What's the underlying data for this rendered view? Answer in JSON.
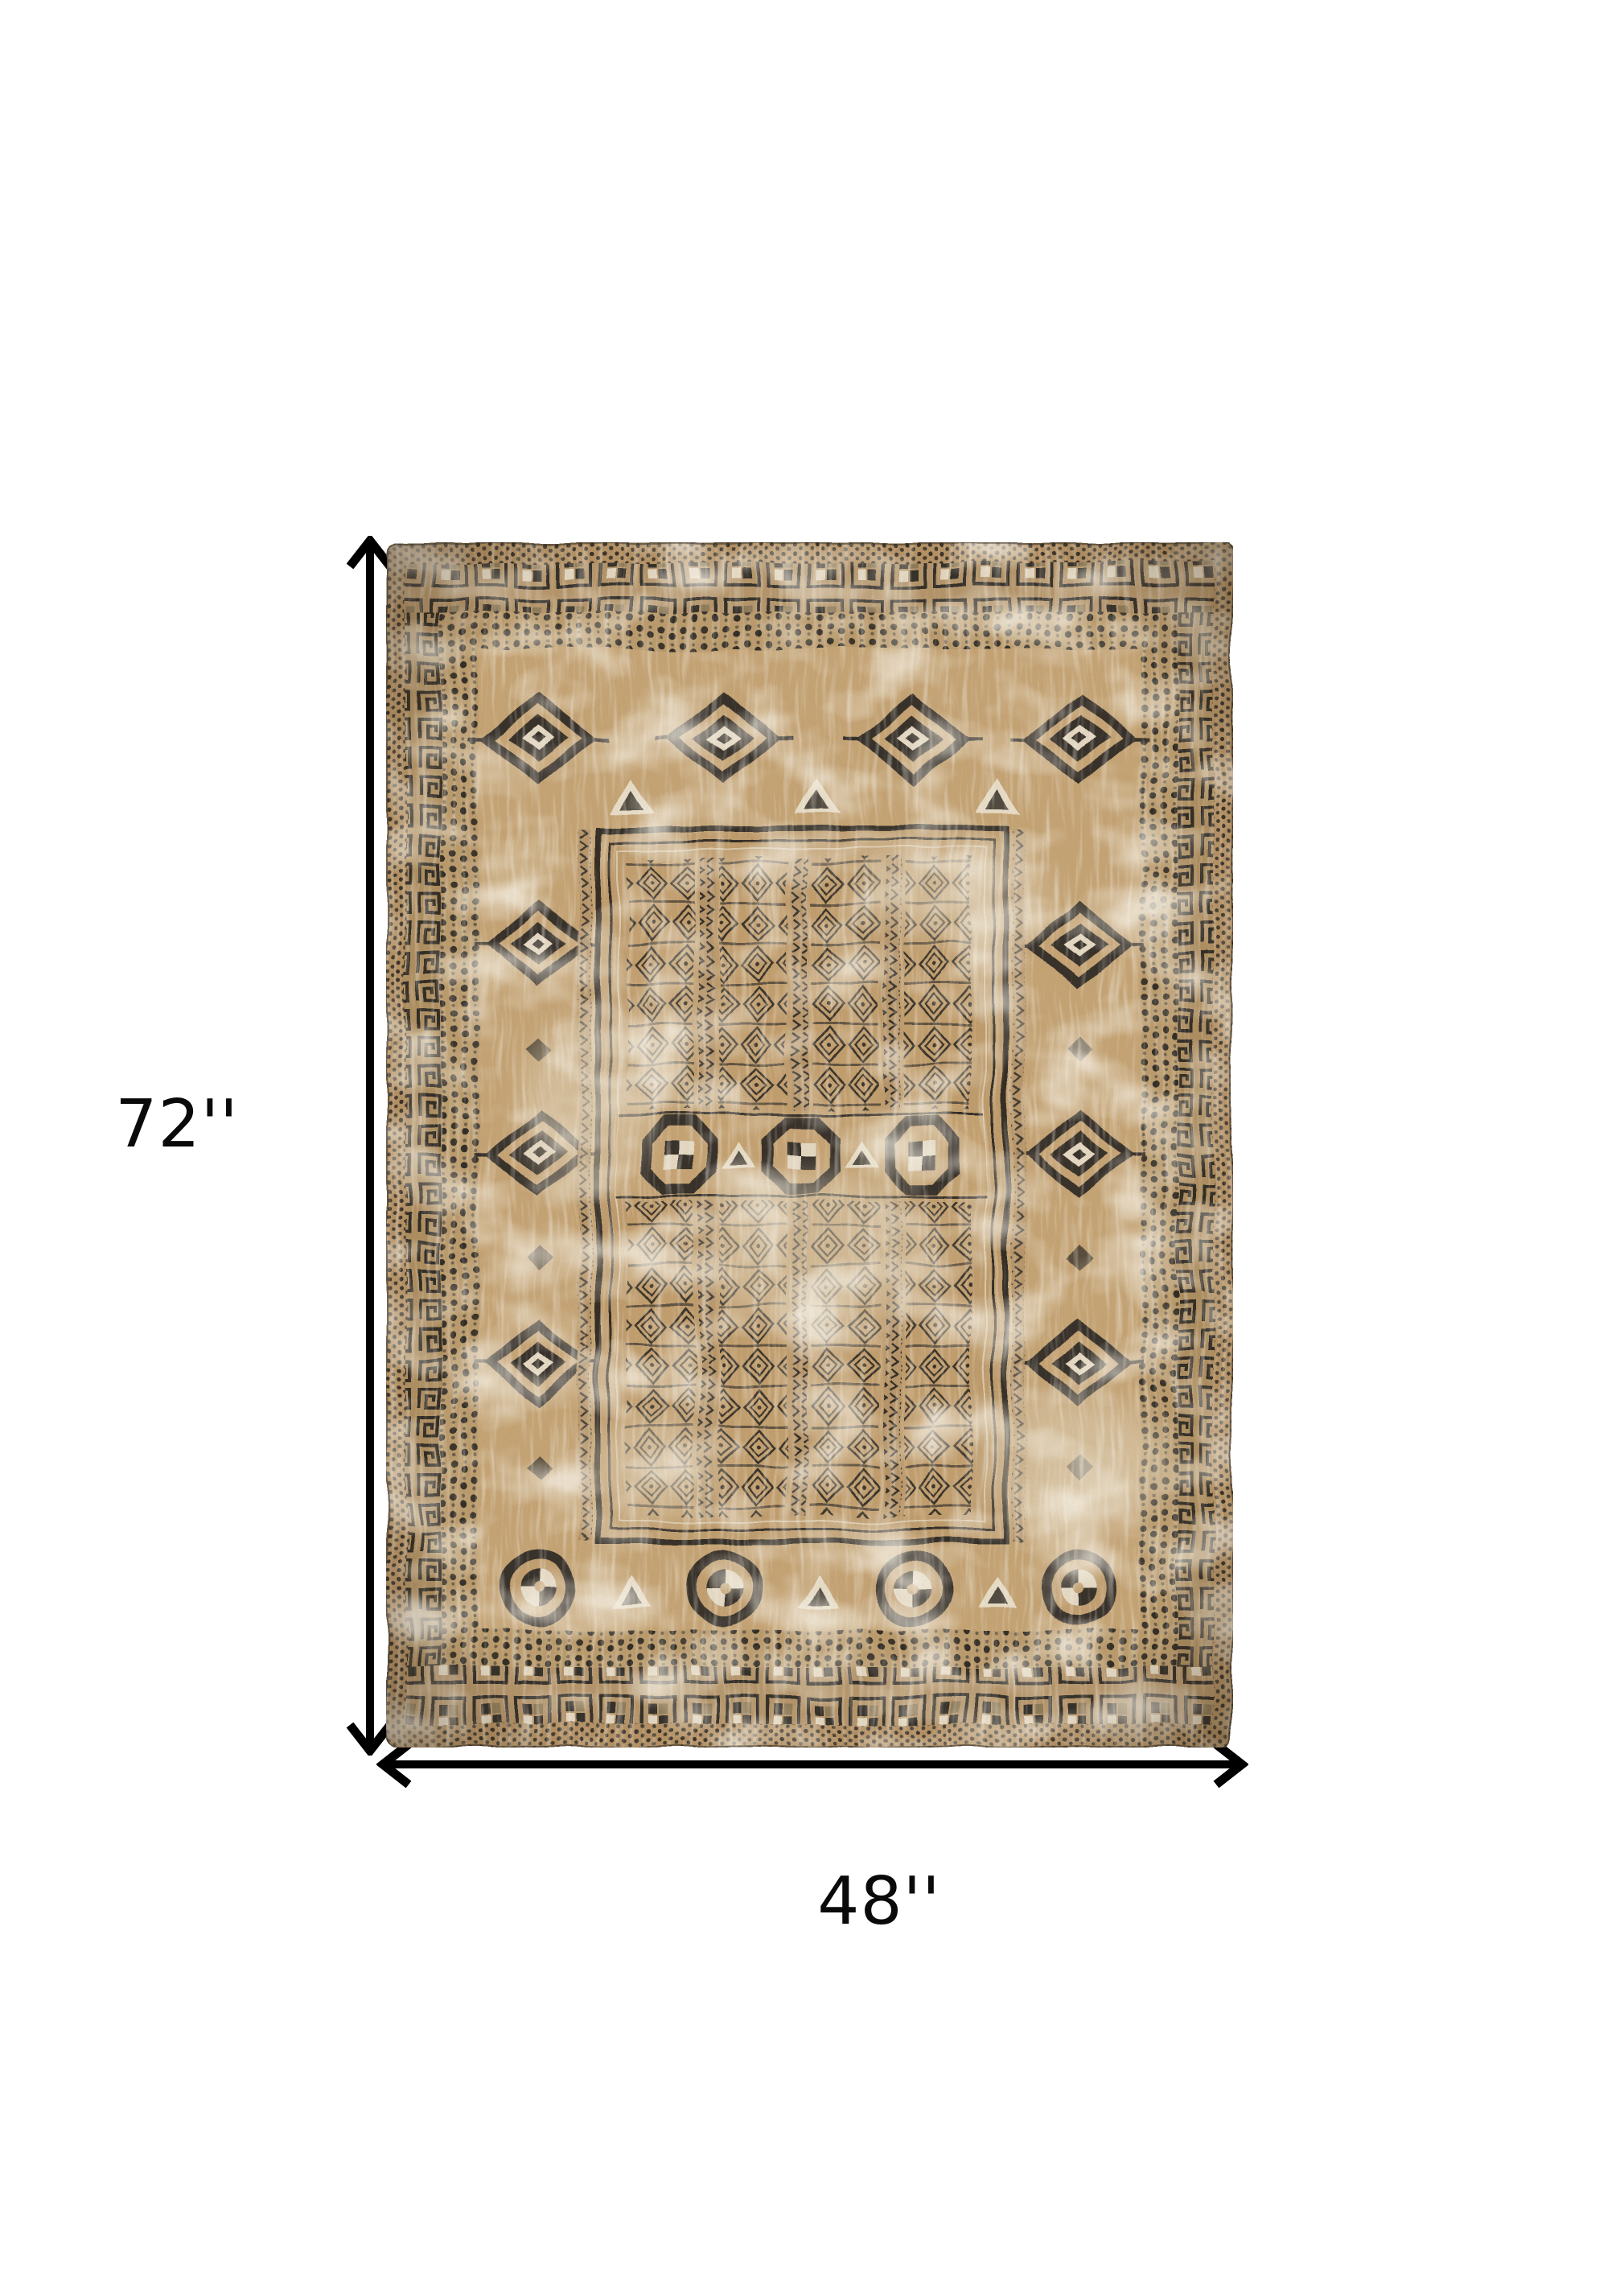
{
  "page": {
    "background_color": "#ffffff",
    "kind": "product-dimension-diagram"
  },
  "diagram": {
    "subject": "Distressed vintage oriental area rug, top-down view, taupe tan field with charcoal black tribal pattern and worn cream patches",
    "rug_colors": {
      "field_tan": "#c3a273",
      "pattern_charcoal": "#37312a",
      "worn_cream": "#e5dac4",
      "band_brown": "#b3946a"
    },
    "arrow_color": "#000000",
    "label_color": "#0a0a0a",
    "height": {
      "label": "72''",
      "inches": 72
    },
    "width": {
      "label": "48''",
      "inches": 48
    }
  }
}
